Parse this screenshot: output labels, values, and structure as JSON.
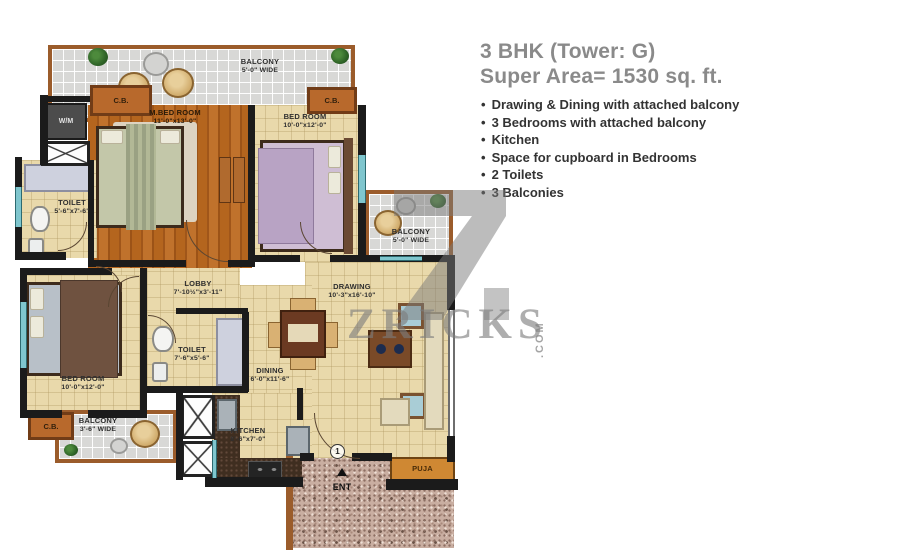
{
  "panel": {
    "title_line1": "3 BHK (Tower: G)",
    "title_line2": "Super Area= 1530 sq. ft.",
    "bullet": "•",
    "features": [
      "Drawing & Dining with attached balcony",
      "3 Bedrooms with attached balcony",
      "Kitchen",
      "Space for cupboard in Bedrooms",
      "2 Toilets",
      "3 Balconies"
    ]
  },
  "plan": {
    "rooms": {
      "balcony_top": {
        "label": "BALCONY",
        "dims": "5'-0\" WIDE"
      },
      "cb_left": {
        "label": "C.B."
      },
      "cb_right": {
        "label": "C.B."
      },
      "cb_bottom": {
        "label": "C.B."
      },
      "wm": {
        "label": "W/M"
      },
      "m_bedroom": {
        "label": "M.BED ROOM",
        "dims": "11'-0\"x13'-0\""
      },
      "bedroom2": {
        "label": "BED ROOM",
        "dims": "10'-0\"x12'-0\""
      },
      "toilet1": {
        "label": "TOILET",
        "dims": "5'-6\"x7'-6\""
      },
      "lobby": {
        "label": "LOBBY",
        "dims": "7'-10½\"x3'-11\""
      },
      "toilet2": {
        "label": "TOILET",
        "dims": "7'-6\"x5'-6\""
      },
      "bedroom3": {
        "label": "BED ROOM",
        "dims": "10'-0\"x12'-0\""
      },
      "balcony_left": {
        "label": "BALCONY",
        "dims": "3'-6\" WIDE"
      },
      "drawing": {
        "label": "DRAWING",
        "dims": "10'-3\"x16'-10\""
      },
      "balcony_right": {
        "label": "BALCONY",
        "dims": "5'-0\" WIDE"
      },
      "dining": {
        "label": "DINING",
        "dims": "6'-0\"x11'-6\""
      },
      "kitchen": {
        "label": "KITCHEN",
        "dims": "8'-6\"x7'-0\""
      },
      "puja": {
        "label": "PUJA"
      },
      "entrance": {
        "label": "ENT",
        "door_number": "1"
      }
    },
    "colors": {
      "wall": "#1b1b1b",
      "floor_beige": "#e9d9ab",
      "floor_wood": "#b4651e",
      "balcony_tile": "#d8d8d6",
      "frame_brown": "#9b5c2b",
      "window_teal": "#7fc6ce",
      "granite": "#c9aea1",
      "puja_orange": "#cf8833",
      "title_gray": "#8a8a8a",
      "text_dark": "#333333"
    }
  },
  "watermark": {
    "logo": "Z",
    "text": "ZRICKS",
    "suffix": ".COM"
  }
}
